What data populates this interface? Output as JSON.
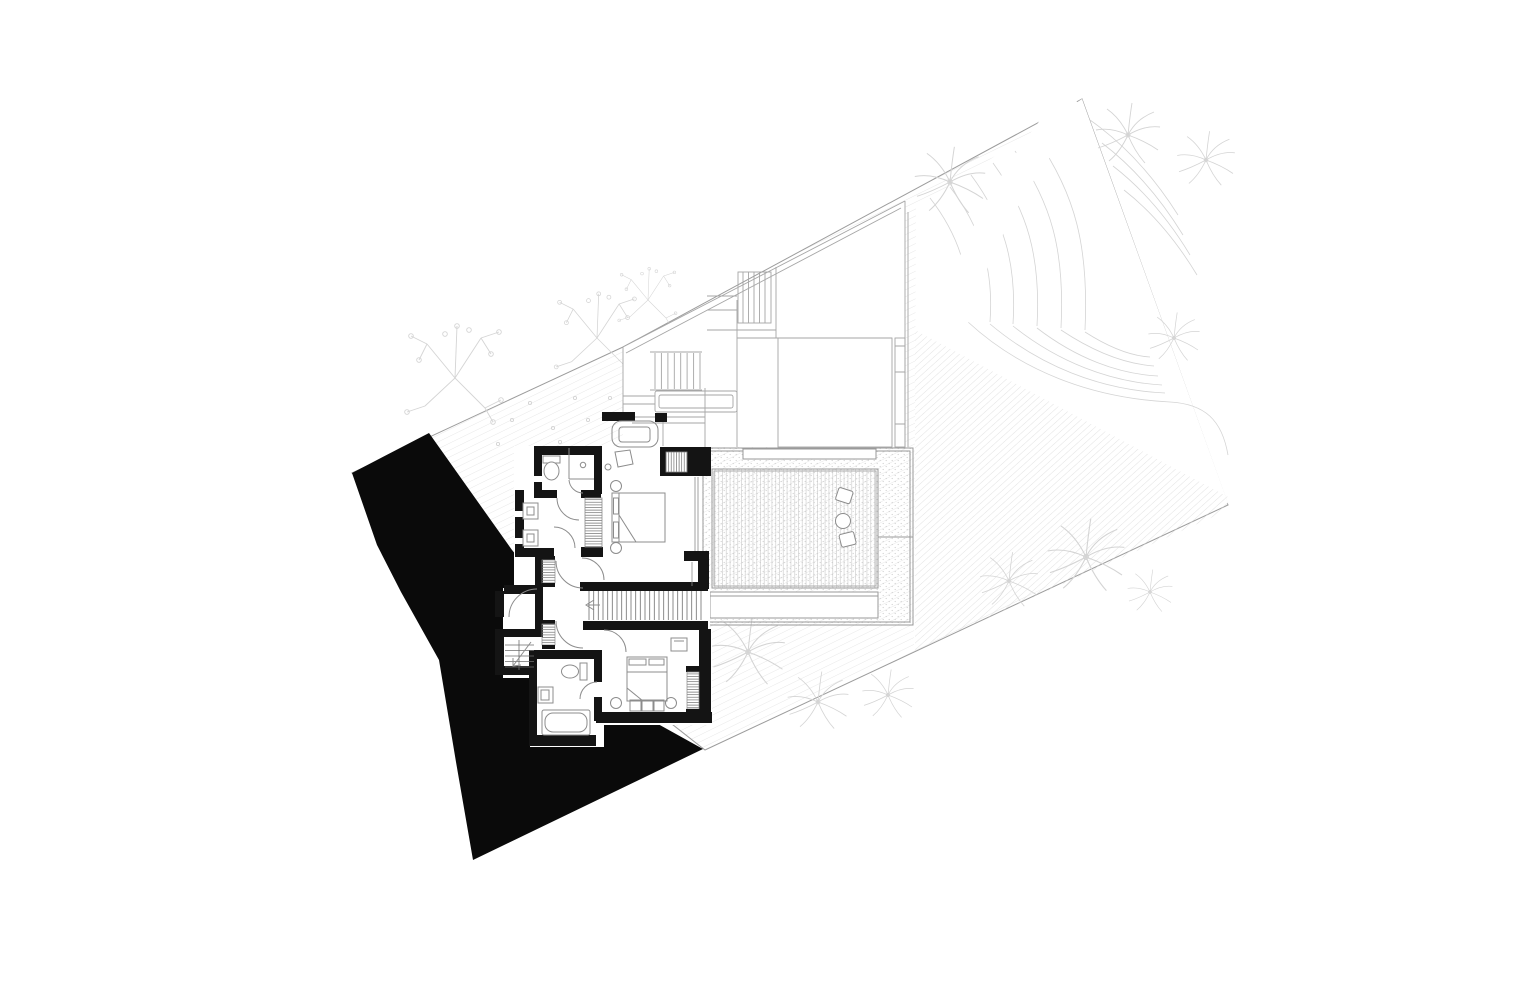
{
  "meta": {
    "drawing_type": "architectural floor plan",
    "level": "bedroom level with roof terrace, pool deck and terraced garden",
    "visible_text": "none"
  },
  "canvas": {
    "width": 1536,
    "height": 994,
    "background": "#ffffff"
  },
  "colors": {
    "paper": "#ffffff",
    "wall": "#141414",
    "terrain": "#0a0a0a",
    "boundary": "#9c9c9c",
    "thin": "#9a9a9a",
    "roof": "#a6a6a6",
    "fixture": "#8c8c8c",
    "landscape": "#d4d4d4",
    "hatch": "#dedede",
    "hatch_dense": "#d6d6d6",
    "deck": "#c9c9c9",
    "stipple": "#cfcfcf",
    "closet": "#6f6f6f",
    "glass": "#8a8a8a"
  },
  "components": {
    "site": [
      "site-boundary",
      "site-hatch",
      "terraced-garden-contours",
      "garden-path",
      "dense-slope-hatch"
    ],
    "vegetation": [
      "palm-tree",
      "frangipani-tree",
      "flower-dots"
    ],
    "terrain": [
      "terrain-cut-mass"
    ],
    "roof_level": [
      "roof-terrace-outline",
      "roof-louvres",
      "roof-stair",
      "pergola-bench",
      "skylight-grid"
    ],
    "deck": [
      "pool-deck",
      "deck-boards",
      "gravel-border",
      "stepping-stones",
      "walkway"
    ],
    "rooms": [
      "master-bedroom",
      "master-bathroom",
      "walk-in-closet",
      "hallway",
      "entry-room",
      "bedroom-2",
      "bathroom-2"
    ],
    "fixtures": [
      "bed",
      "armchair",
      "stool",
      "side-table",
      "toilet",
      "shower",
      "vanity-basin",
      "sink",
      "bathtub",
      "wardrobe",
      "desk"
    ],
    "circulation": [
      "main-staircase",
      "corner-staircase",
      "stair-direction-arrow",
      "door-swing"
    ]
  }
}
